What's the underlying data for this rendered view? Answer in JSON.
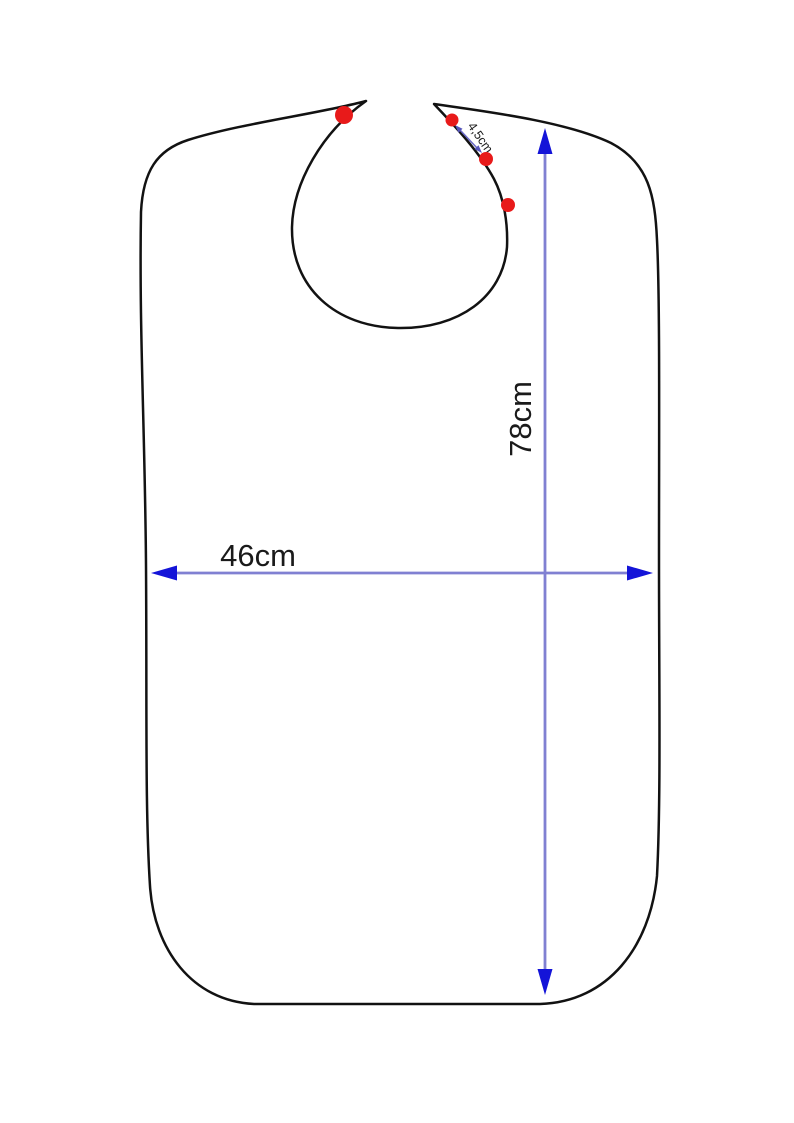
{
  "diagram": {
    "title": "bib-sewing-pattern",
    "labels": {
      "width": "46cm",
      "height": "78cm",
      "snap_spacing": "4,5cm"
    },
    "colors": {
      "outline": "#121212",
      "dimension_line": "#8080d2",
      "arrowhead": "#1414d8",
      "snap_dot": "#e81a1a",
      "background": "#ffffff"
    },
    "snap_dots": {
      "left_tab_count": 1,
      "right_tab_count": 3
    }
  }
}
